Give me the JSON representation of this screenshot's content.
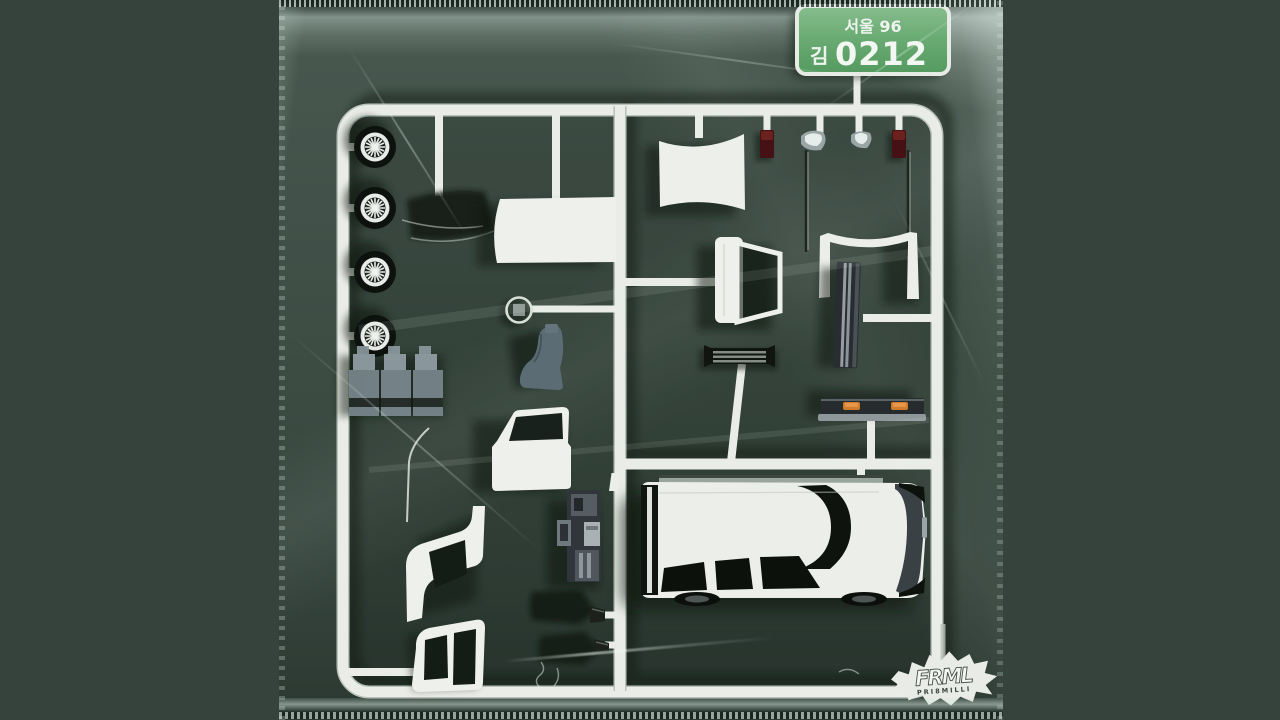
{
  "artwork": {
    "type": "album-cover",
    "subject": "white plastic model-kit sprue of a car sealed in a green shrink-wrap bag",
    "license_plate": {
      "line1": "서울 96",
      "owner_char": "김",
      "number": "0212"
    },
    "logo": {
      "brand": "FRML",
      "subtext": "PRI8MILLI"
    },
    "colors": {
      "outer_background": "#36433c",
      "bag_green": "#3c4c43",
      "sprue_white": "#e9ece7",
      "part_dark": "#0e130e",
      "part_grey": "#7e8c93",
      "seat_grey": "#5c6c74",
      "tail_light_red": "#451114",
      "indicator_orange": "#cf7c2c",
      "plate_green": "#5fa46a",
      "plate_text": "#eef4ee"
    },
    "parts": [
      "wheel",
      "wheel",
      "wheel",
      "wheel",
      "engine-block",
      "windshield-glass",
      "roof-panel",
      "steering-wheel",
      "seat",
      "front-door",
      "front-fender",
      "cab-frame",
      "center-console",
      "rear-window-frame",
      "tail-light",
      "tail-light",
      "side-mirror",
      "side-mirror",
      "antenna",
      "antenna",
      "front-bumper",
      "door-sill-trim",
      "front-grille",
      "rear-bumper",
      "car-body",
      "mud-flap",
      "mud-flap",
      "exhaust-tip"
    ]
  }
}
